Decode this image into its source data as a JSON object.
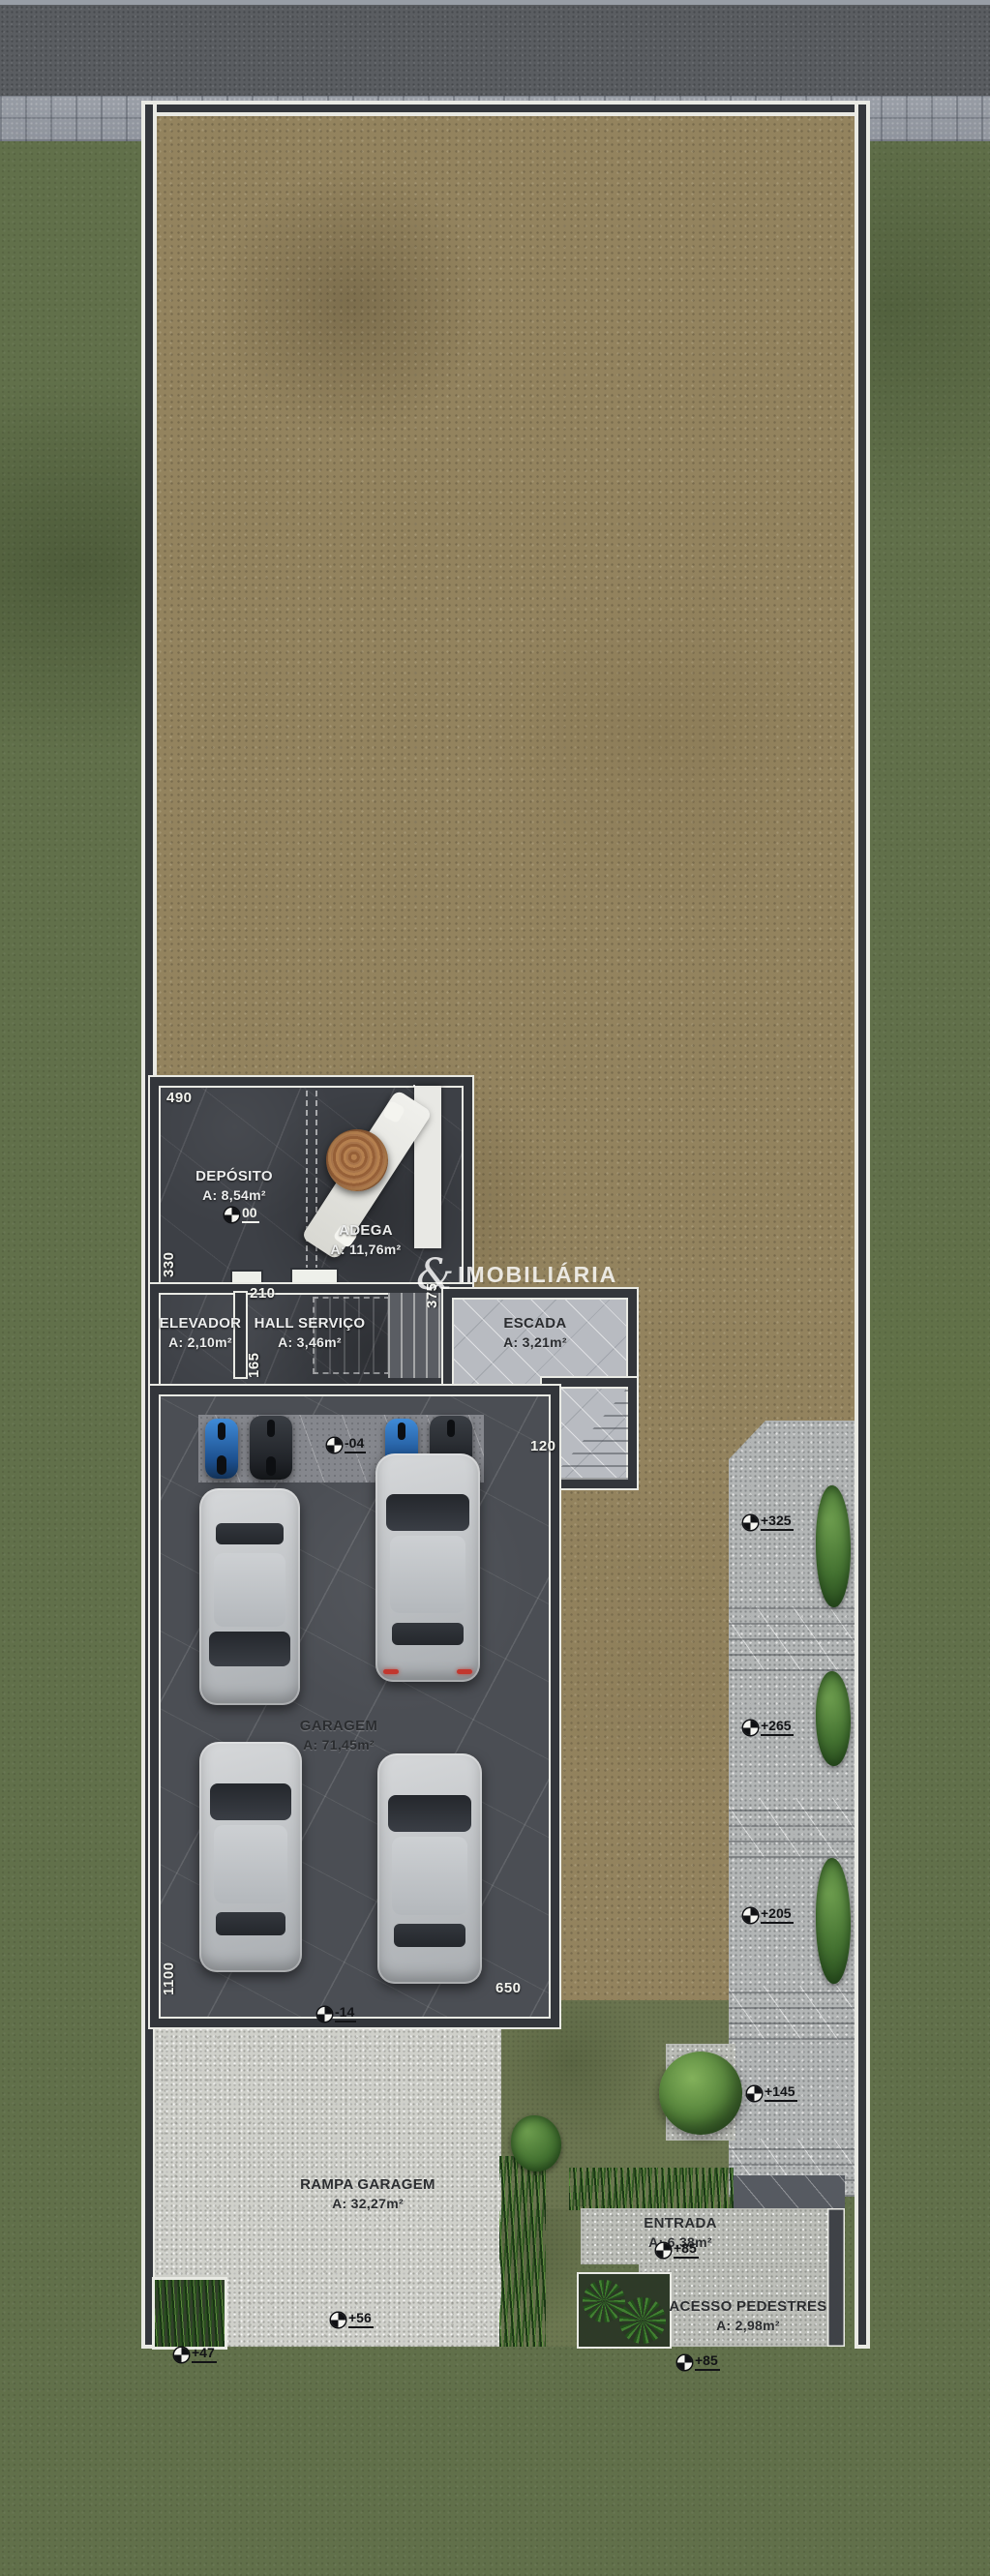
{
  "plan": {
    "watermark": {
      "symbol": "&",
      "name": "IMOBILIÁRIA"
    },
    "rooms": {
      "deposito": {
        "name": "DEPÓSITO",
        "area": "A: 8,54m²"
      },
      "adega": {
        "name": "ADEGA",
        "area": "A: 11,76m²"
      },
      "elevador": {
        "name": "ELEVADOR",
        "area": "A: 2,10m²"
      },
      "hall": {
        "name": "HALL SERVIÇO",
        "area": "A: 3,46m²"
      },
      "escada": {
        "name": "ESCADA",
        "area": "A: 3,21m²"
      },
      "garagem": {
        "name": "GARAGEM",
        "area": "A: 71,45m²"
      },
      "rampa": {
        "name": "RAMPA GARAGEM",
        "area": "A: 32,27m²"
      },
      "entrada": {
        "name": "ENTRADA",
        "area": "A: 6,38m²"
      },
      "acesso": {
        "name": "ACESSO PEDESTRES",
        "area": "A: 2,98m²"
      }
    },
    "dimensions": {
      "d490": "490",
      "d330": "330",
      "d210": "210",
      "d165": "165",
      "d375": "375",
      "d120": "120",
      "d1100": "1100",
      "d650": "650"
    },
    "levels": {
      "deposito": "00",
      "garage": "-04",
      "ramp_top": "-14",
      "ramp_bottom": "+56",
      "sidewalk_left": "+47",
      "sidewalk_right": "+85",
      "entrance": "+85",
      "path_1": "+145",
      "path_2": "+205",
      "path_3": "+265",
      "path_4": "+325"
    },
    "palette": {
      "grass": "#61704a",
      "dirt": "#93835e",
      "slab_dark": "#3d4046",
      "slab_light": "#b8bbc1",
      "gravel": "#cfd0ca",
      "wall_core": "#33363b",
      "wall_outline": "#e9eae4",
      "sidewalk": "#a5aab2",
      "road": "#5a5d61",
      "moto_blue": "#2d7fd4",
      "taillight_red": "#c2372e"
    }
  }
}
